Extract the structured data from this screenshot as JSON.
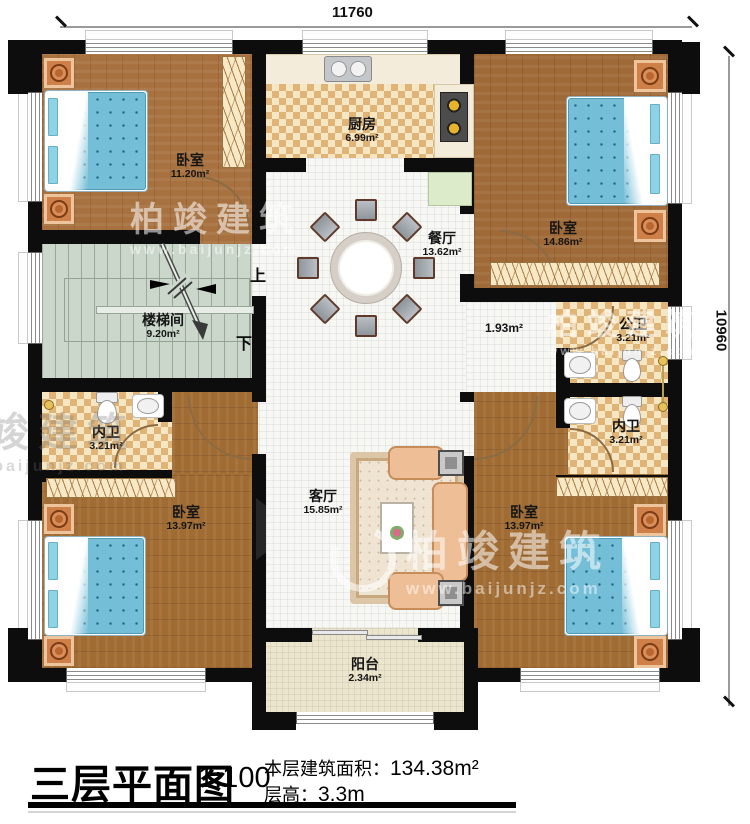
{
  "watermark": {
    "brand": "柏竣建筑",
    "url": "www.baijunjz.com"
  },
  "dimensions": {
    "width": "11760",
    "height": "10960"
  },
  "stairs": {
    "up": "上",
    "down": "下"
  },
  "rooms": {
    "bedroom_tl": {
      "name": "卧室",
      "area": "11.20m²"
    },
    "kitchen": {
      "name": "厨房",
      "area": "6.99m²"
    },
    "bedroom_tr": {
      "name": "卧室",
      "area": "14.86m²"
    },
    "dining": {
      "name": "餐厅",
      "area": "13.62m²"
    },
    "stairwell": {
      "name": "楼梯间",
      "area": "9.20m²"
    },
    "hallway": {
      "area": "1.93m²"
    },
    "bath_public": {
      "name": "公卫",
      "area": "3.21m²"
    },
    "bath_inner_left": {
      "name": "内卫",
      "area": "3.21m²"
    },
    "bath_inner_right": {
      "name": "内卫",
      "area": "3.21m²"
    },
    "living": {
      "name": "客厅",
      "area": "15.85m²"
    },
    "bedroom_bl": {
      "name": "卧室",
      "area": "13.97m²"
    },
    "bedroom_br": {
      "name": "卧室",
      "area": "13.97m²"
    },
    "balcony": {
      "name": "阳台",
      "area": "2.34m²"
    }
  },
  "title_block": {
    "title": "三层平面图",
    "scale": "1:100",
    "area_label": "本层建筑面积：",
    "area_value": "134.38m²",
    "floor_height_label": "层高：",
    "floor_height_value": "3.3m"
  }
}
